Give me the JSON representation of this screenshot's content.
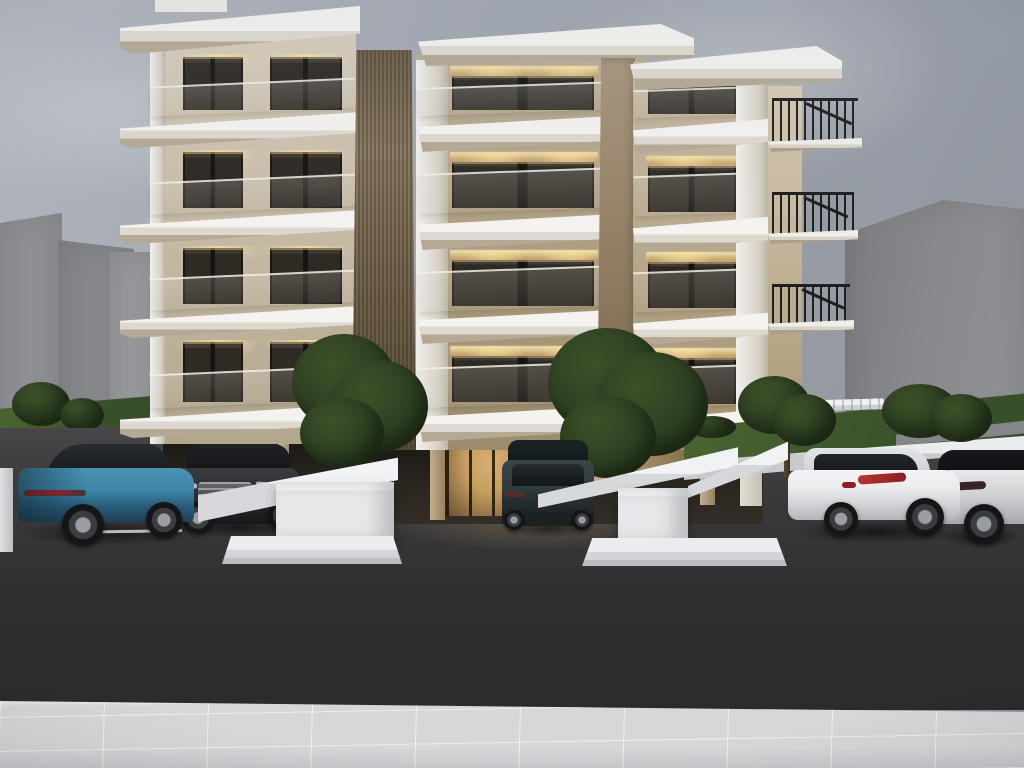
{
  "scene": {
    "type": "architectural-dusk-render",
    "subject": "modern-four-storey-apartment-building",
    "floors": 4,
    "side_balcony_levels": 3,
    "cars_parked": 5,
    "trees": 4,
    "elements": [
      "overcast-dusk-sky",
      "gray-neighbor-buildings-left",
      "gray-neighbor-building-right",
      "white-concrete-balcony-slabs",
      "glass-balustrades",
      "black-metal-side-railings",
      "vertical-wood-slat-feature",
      "stone-feature-column",
      "warm-interior-downlights",
      "pilotis-parking-level",
      "lit-entrance-lobby",
      "white-planter-walls",
      "white-entry-platforms",
      "olive-trees",
      "grass-slopes",
      "white-pergola-canopy",
      "dark-asphalt-parking",
      "white-tiled-sidewalk",
      "teal-crossover-car",
      "dark-gray-mercedes-suv",
      "dark-teal-suv-rear",
      "white-tucson-suv",
      "silver-velar-suv"
    ]
  },
  "palette": {
    "sky1": "#b2b6be",
    "sky2": "#9aa0a8",
    "sky3": "#8e939c",
    "neighbor1": "#8e8f92",
    "neighbor2": "#85868a",
    "neighbor3": "#7b7c80",
    "slabWhite": "#f4f3f0",
    "slabShade": "#b4a995",
    "wallCream": "#d6ccba",
    "wallTan": "#ab9b7d",
    "wood": "#8a7a62",
    "woodDark": "#6c5e47",
    "stone": "#8d7a61",
    "glass": "#2e2a24",
    "warmLight": "#f0dfae",
    "lobbyGlow": "#c79e5e",
    "rail": "#1f1f21",
    "grass": "#4a6531",
    "grassDark": "#37502a",
    "foliage": "#3d5029",
    "foliageDark": "#283a1e",
    "trunk": "#3d3020",
    "planter": "#e9eaec",
    "asphalt1": "#47474a",
    "asphalt2": "#2b2b2d",
    "sidewalk": "#d6d7d9",
    "carTeal": "#3e86a8",
    "carTealDark": "#1e4156",
    "carGray": "#3a3c3f",
    "carDarkSuv": "#2e3a3d",
    "carWhite": "#ececee",
    "tailRed": "#b5352e"
  }
}
